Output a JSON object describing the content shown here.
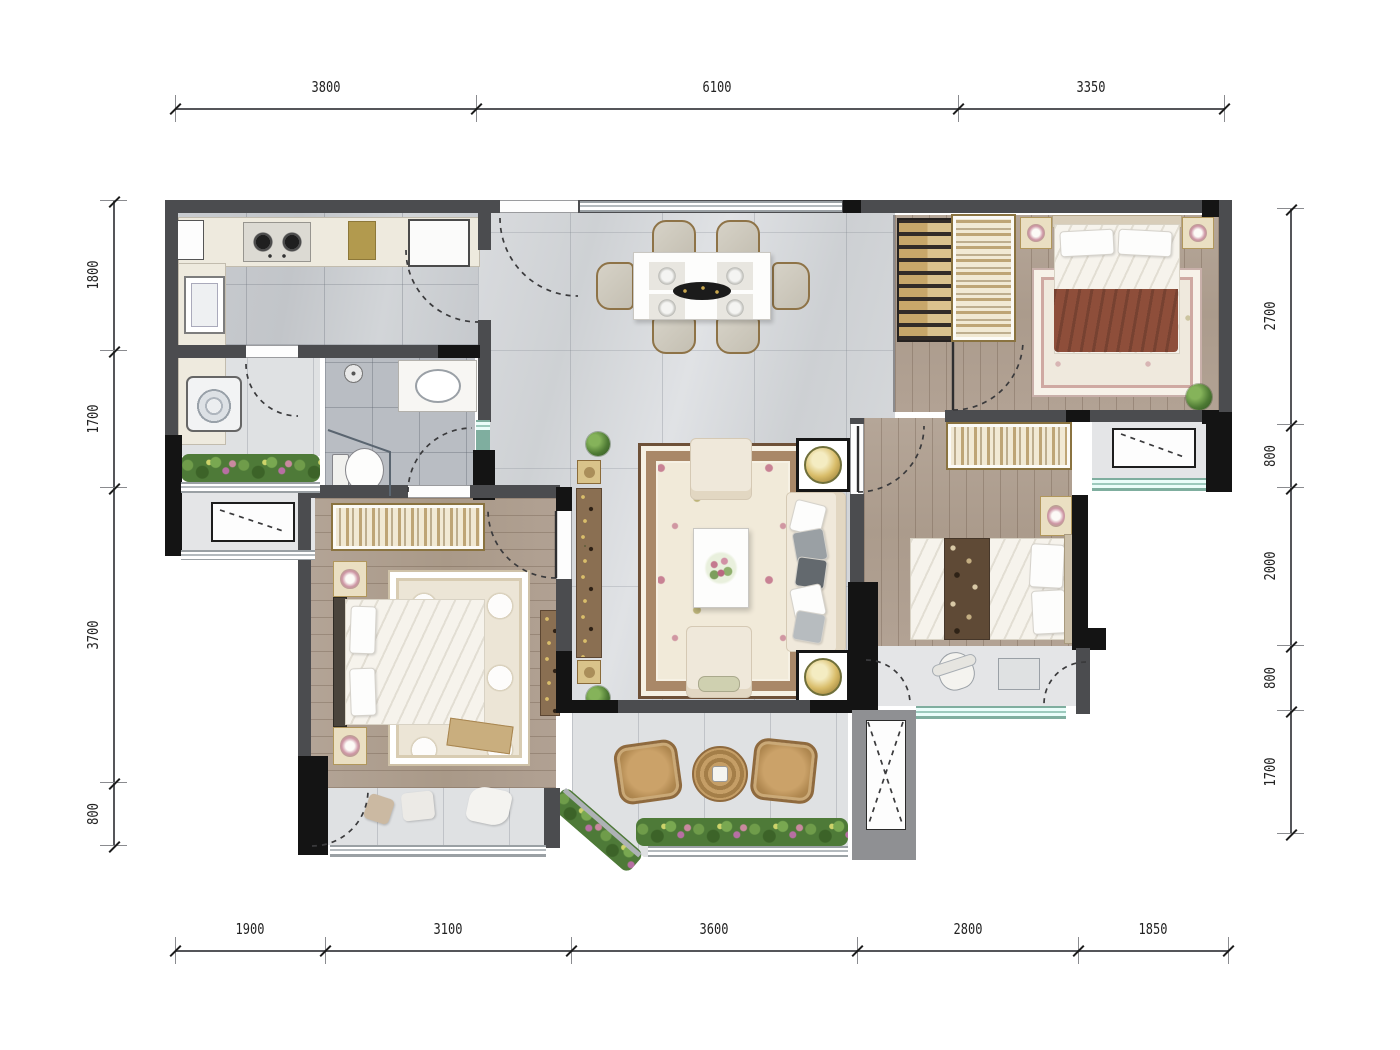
{
  "drawing": {
    "kind": "residential floor plan, top-down rendered view",
    "units": "mm"
  },
  "dimension_chains": {
    "top": {
      "orient": "h",
      "line": 108,
      "label_offset": -21,
      "ticks": [
        175,
        476,
        958,
        1224
      ],
      "labels": [
        "3800",
        "6100",
        "3350"
      ]
    },
    "bottom": {
      "orient": "h",
      "line": 950,
      "label_offset": -21,
      "ticks": [
        175,
        325,
        571,
        857,
        1078,
        1228
      ],
      "labels": [
        "1900",
        "3100",
        "3600",
        "2800",
        "1850"
      ]
    },
    "left": {
      "orient": "v",
      "line": 113,
      "label_offset": -20,
      "ticks": [
        200,
        350,
        487,
        782,
        845
      ],
      "labels": [
        "1800",
        "1700",
        "3700",
        "800"
      ]
    },
    "right": {
      "orient": "v",
      "line": 1290,
      "label_offset": -20,
      "ticks": [
        208,
        424,
        487,
        645,
        710,
        833
      ],
      "labels": [
        "2700",
        "800",
        "2000",
        "800",
        "1700"
      ]
    }
  },
  "palette": {
    "wall_gray": "#4b4c4f",
    "wall_black": "#141414",
    "marble_floor": "#d4d6d9",
    "wood_floor": "#ad9e8f",
    "bath_tile": "#b9bdc3",
    "balcony_tile": "#dfe1e3",
    "furniture_cream": "#f0e9db",
    "wardrobe_tan": "#c8a76a",
    "blanket_rust": "#8e4e3a",
    "plant_green": "#4e7a38",
    "accent_gold": "#c9a84e",
    "dim_text": "#222222"
  },
  "symbols": {
    "door_swing": "dashed quarter-circle arc",
    "ac_unit": "rectangle with dashed diagonal",
    "flue": "rectangle with dashed X cross",
    "window": "triple parallel glazing lines"
  }
}
